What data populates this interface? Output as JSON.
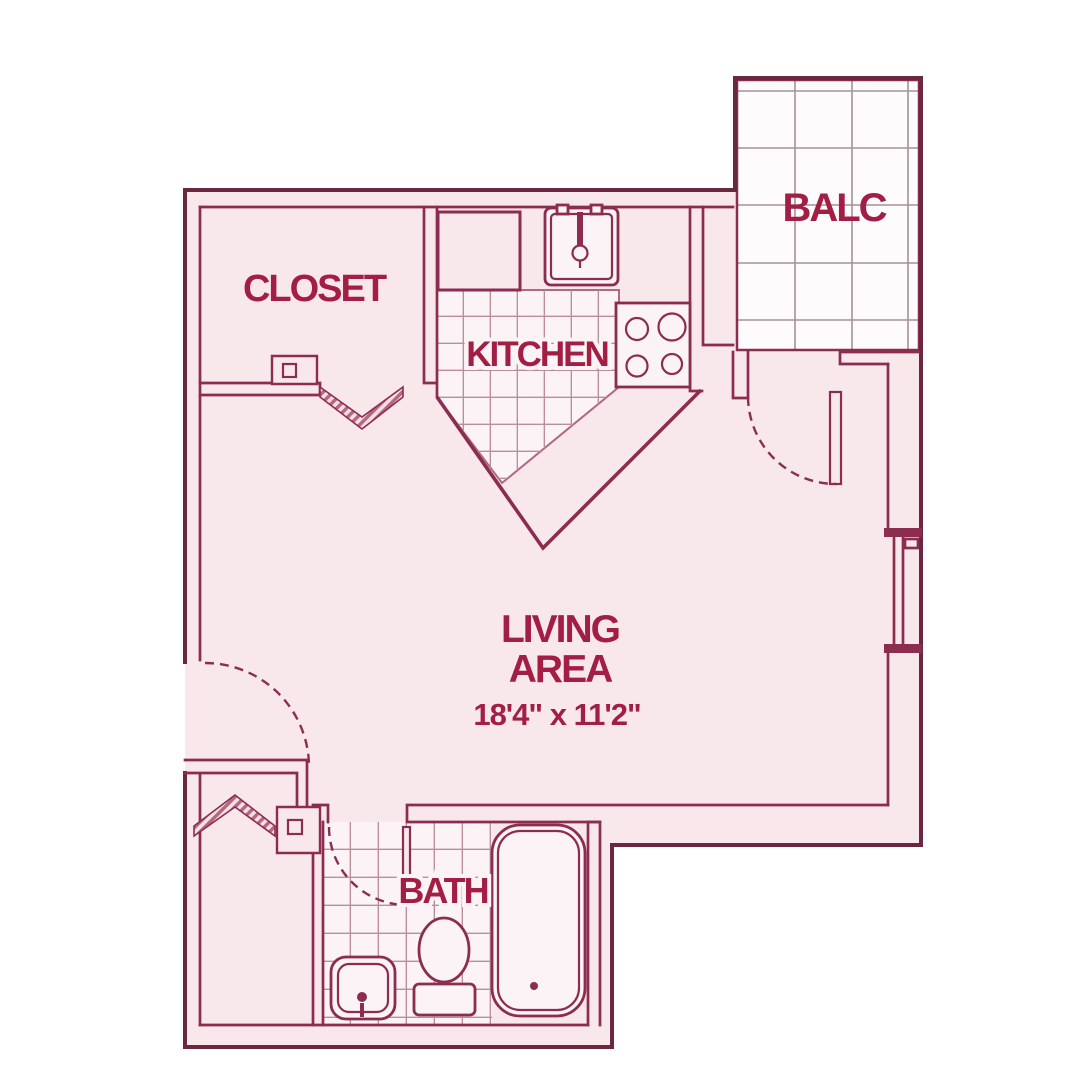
{
  "colors": {
    "bg": "#ffffff",
    "floor": "#f8e8ec",
    "floor-bright": "#fbf3f5",
    "balcony": "#fdfbfb",
    "wall": "#8c2d4f",
    "wall-dark": "#692741",
    "grid": "#a5929a",
    "tile": "#bc8e9c",
    "label": "#a31e45"
  },
  "plan": {
    "rooms": {
      "closet": {
        "label": "CLOSET"
      },
      "kitchen": {
        "label": "KITCHEN"
      },
      "balcony": {
        "label": "BALC"
      },
      "living_area": {
        "label_line1": "LIVING",
        "label_line2": "AREA",
        "dimensions": "18'4\" x 11'2\""
      },
      "bath": {
        "label": "BATH"
      }
    },
    "fixtures": [
      "kitchen-counter",
      "kitchen-sink",
      "stove",
      "bathtub",
      "toilet",
      "bath-sink"
    ],
    "doors": [
      "entry-door",
      "balcony-door",
      "bath-door",
      "closet-bifold-door",
      "storage-bifold-door"
    ],
    "windows": [
      "living-area-window"
    ]
  }
}
